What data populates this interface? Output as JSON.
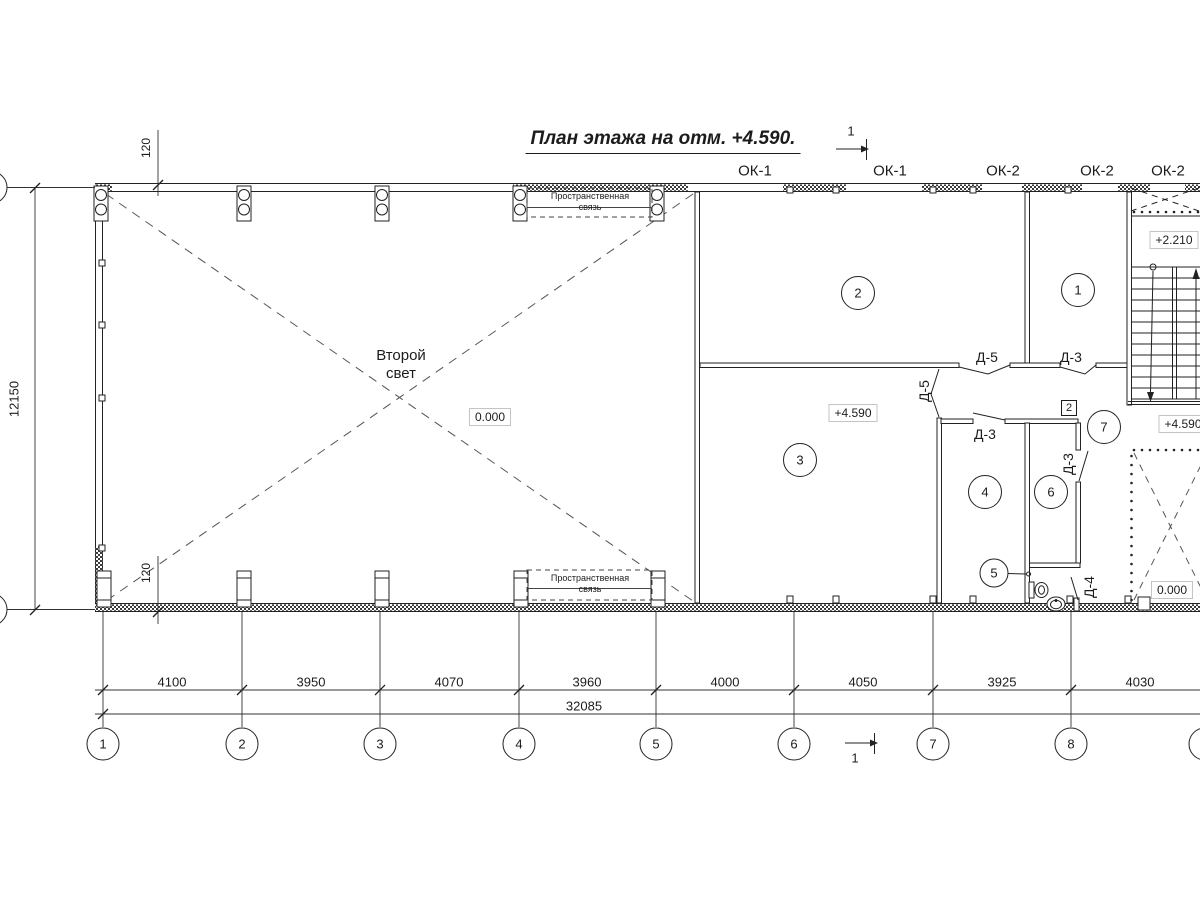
{
  "title": "План этажа на отм. +4.590.",
  "section_mark": {
    "label": "1"
  },
  "windows": {
    "ok1_a": "ОК-1",
    "ok1_b": "ОК-1",
    "ok2_a": "ОК-2",
    "ok2_b": "ОК-2",
    "ok2_c": "ОК-2"
  },
  "doors": {
    "d5_top": "Д-5",
    "d3_top": "Д-3",
    "d5_side": "Д-5",
    "d3_room4": "Д-3",
    "d3_room6": "Д-3",
    "d4_wc": "Д-4"
  },
  "rooms": {
    "r1": "1",
    "r2": "2",
    "r3": "3",
    "r4": "4",
    "r5": "5",
    "r6": "6",
    "r7": "7"
  },
  "annotations": {
    "second_light": "Второй\nсвет",
    "spatial_brace": "Пространственная\nсвязь",
    "node_marker": "2"
  },
  "elevations": {
    "hall": "0.000",
    "room3": "+4.590",
    "stair_mid": "+2.210",
    "stair_top": "+4.590",
    "opening": "0.000"
  },
  "dimensions": {
    "segments": [
      "4100",
      "3950",
      "4070",
      "3960",
      "4000",
      "4050",
      "3925",
      "4030"
    ],
    "total": "32085",
    "height": "12150",
    "offset_top": "120",
    "offset_bottom": "120"
  },
  "grid_axes": [
    "1",
    "2",
    "3",
    "4",
    "5",
    "6",
    "7",
    "8"
  ]
}
